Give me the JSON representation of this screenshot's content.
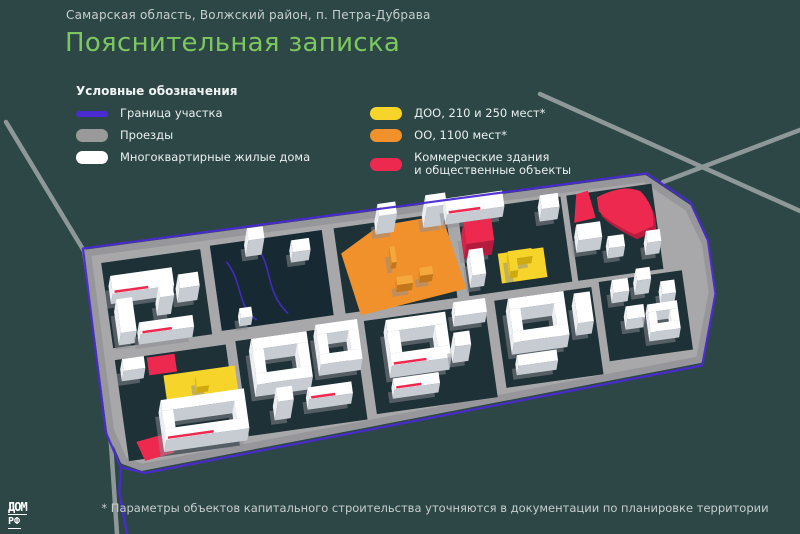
{
  "header": {
    "location": "Самарская область, Волжский район, п. Петра-Дубрава",
    "title": "Пояснительная записка"
  },
  "legend": {
    "title": "Условные обозначения",
    "boundary": "Граница участка",
    "driveways": "Проезды",
    "apartments": "Многоквартирные жилые дома",
    "kindergarten": "ДОО, 210 и 250 мест*",
    "school": "ОО, 1100 мест*",
    "commercial_line1": "Коммерческие здания",
    "commercial_line2": "и общественные объекты"
  },
  "footnote": "* Параметры объектов капитального строительства уточняются в документации по планировке территории",
  "logo": {
    "top": "ДОМ",
    "bottom": "РФ"
  },
  "colors": {
    "background": "#2d4747",
    "accent_green": "#7cc75e",
    "text_light": "#c7cecd",
    "boundary_purple": "#4a2ad2",
    "road_gray": "#9a9a9a",
    "building_white": "#ffffff",
    "kindergarten_yellow": "#f6d42a",
    "school_orange": "#f0912c",
    "commercial_red": "#ee2950"
  }
}
